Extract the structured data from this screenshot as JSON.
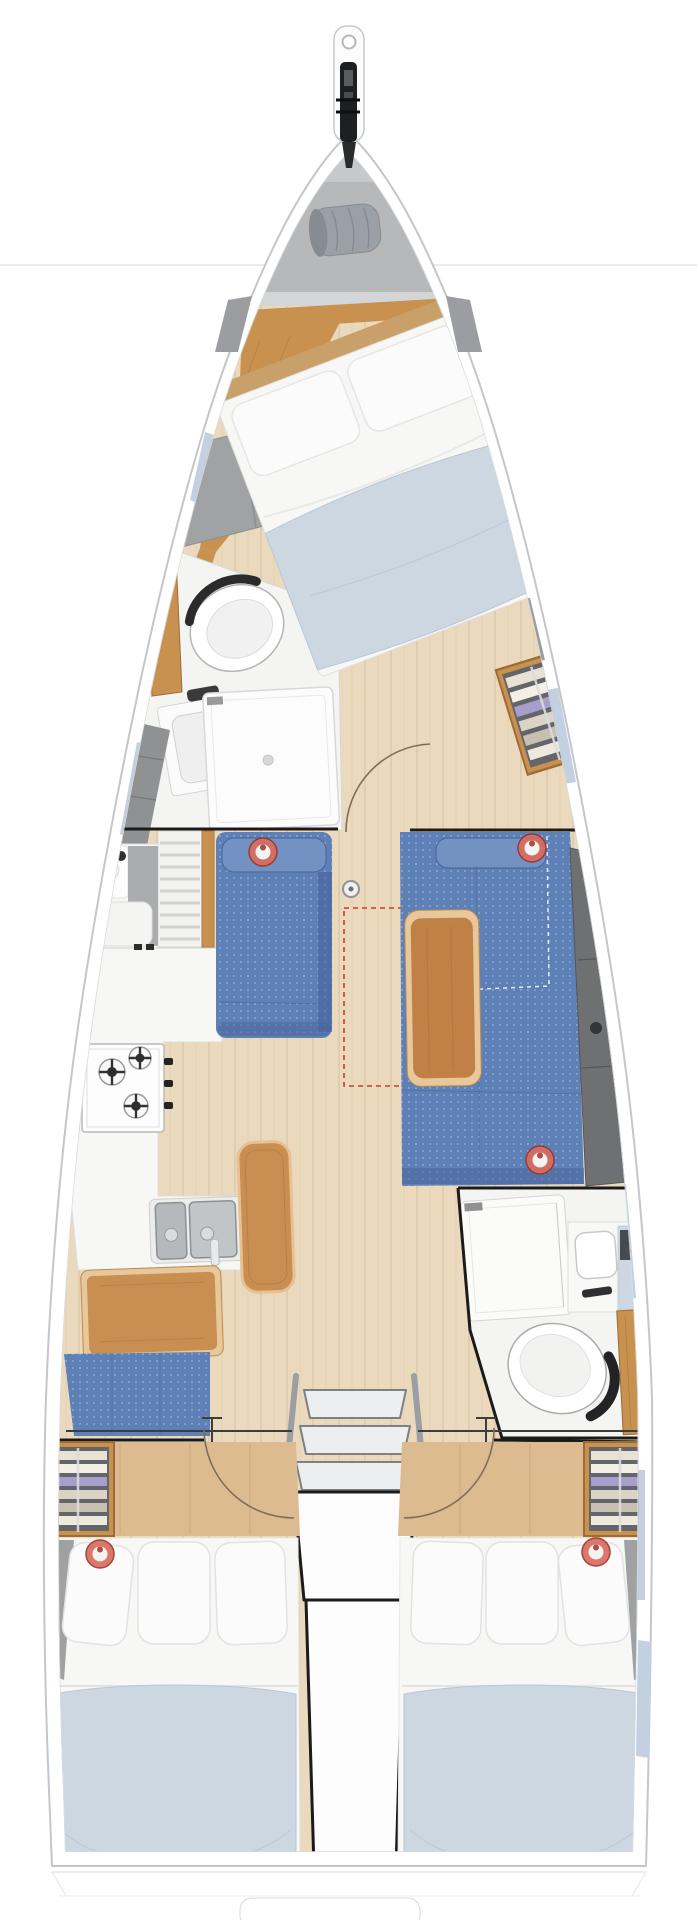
{
  "meta": {
    "title": "Sailing yacht interior layout plan - top view",
    "view": "deck plan",
    "orientation": "bow up, stern down"
  },
  "palette": {
    "background": "#ffffff",
    "hull_stroke": "#c3c6ca",
    "deck_white": "#fafafa",
    "waterline": "#ececec",
    "locker_gray": "#b6b8ba",
    "band_dark": "#d4d5d7",
    "bag_gray": "#9aa0a5",
    "bag_dark": "#868c91",
    "anthracite": "#1e1f21",
    "wood_orange": "#c8914f",
    "wood_edge": "#9c6c34",
    "floor_light": "#ead9bd",
    "cabin_floor": "#ddbb90",
    "head_white": "#f4f4f3",
    "fixture_white": "#fbfbfb",
    "fixture_stroke": "#d5d5d3",
    "steel": "#b6b9bb",
    "steel_dark": "#8d9093",
    "settee_blue": "#5d80b6",
    "settee_blue_dark": "#47639a",
    "bolster_blue": "#7392c4",
    "backrest_gray": "#6f7072",
    "hull_band_gray": "#8f9193",
    "hull_band_blue": "#c2d0e2",
    "table_wood": "#c08046",
    "table_border": "#e8c79b",
    "leather_tan": "#c98e52",
    "bed_white": "#f7f7f6",
    "pillow_white": "#fbfbfb",
    "pillow_stroke": "#e2e2e2",
    "duvet_blue": "#cdd7e2",
    "duvet_shade": "#b9c6d4",
    "marker_red": "#d96c5f",
    "marker_red_deep": "#9e3328",
    "chrome": "#eceeef",
    "chrome_dark": "#7d8084",
    "line_black": "#1b1b1b",
    "door_arc": "#7d6e59",
    "dash_red": "#cc3b2f",
    "wardrobe_dark": "#63656a"
  },
  "fixtures": [
    "bowsprit-anchor-roller",
    "anchor-locker-sail-bag",
    "owner-cabin-double-berth",
    "forward-head-toilet",
    "forward-head-sink",
    "forward-head-shower",
    "forward-wardrobe-shelves",
    "port-settee",
    "starboard-settee",
    "saloon-table",
    "mast-post",
    "optional-area-dashed-outline",
    "louvered-locker",
    "galley-sink-top",
    "galley-stove-3-burner",
    "galley-double-sink",
    "nav-bench",
    "chart-table",
    "nav-seat",
    "companionway-ladder",
    "engine-box",
    "aft-head-shower",
    "aft-head-sink",
    "aft-head-toilet",
    "aft-wardrobe-port",
    "aft-wardrobe-starboard",
    "aft-berth-port",
    "aft-berth-starboard",
    "red-ring-marker-x5"
  ]
}
